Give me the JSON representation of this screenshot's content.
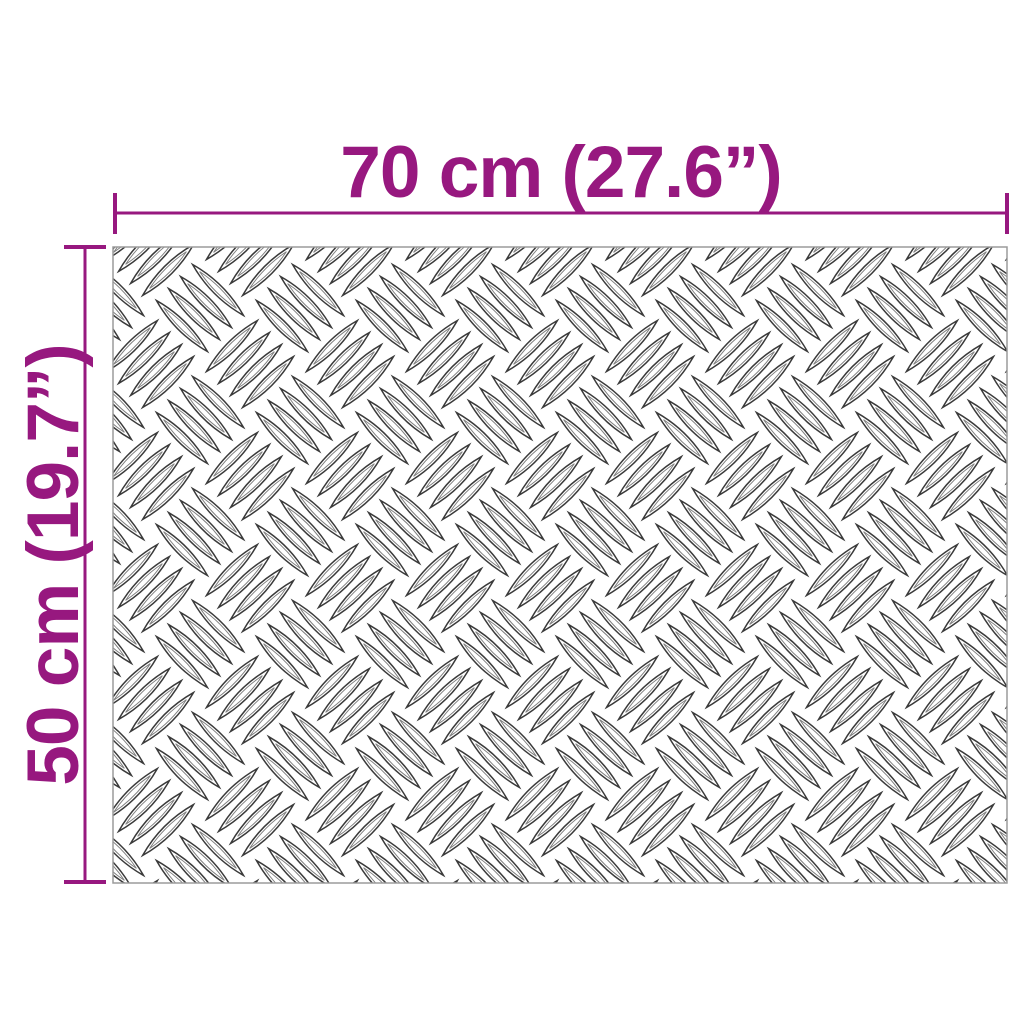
{
  "diagram": {
    "width_label": "70 cm (27.6”)",
    "height_label": "50 cm (19.7”)",
    "texture_name": "aluminium-checker-plate",
    "colors": {
      "dimension": "#97187F",
      "plate_border": "#9B9B9B",
      "pattern_stroke": "#3A3A3A",
      "background": "#FFFFFF"
    }
  }
}
